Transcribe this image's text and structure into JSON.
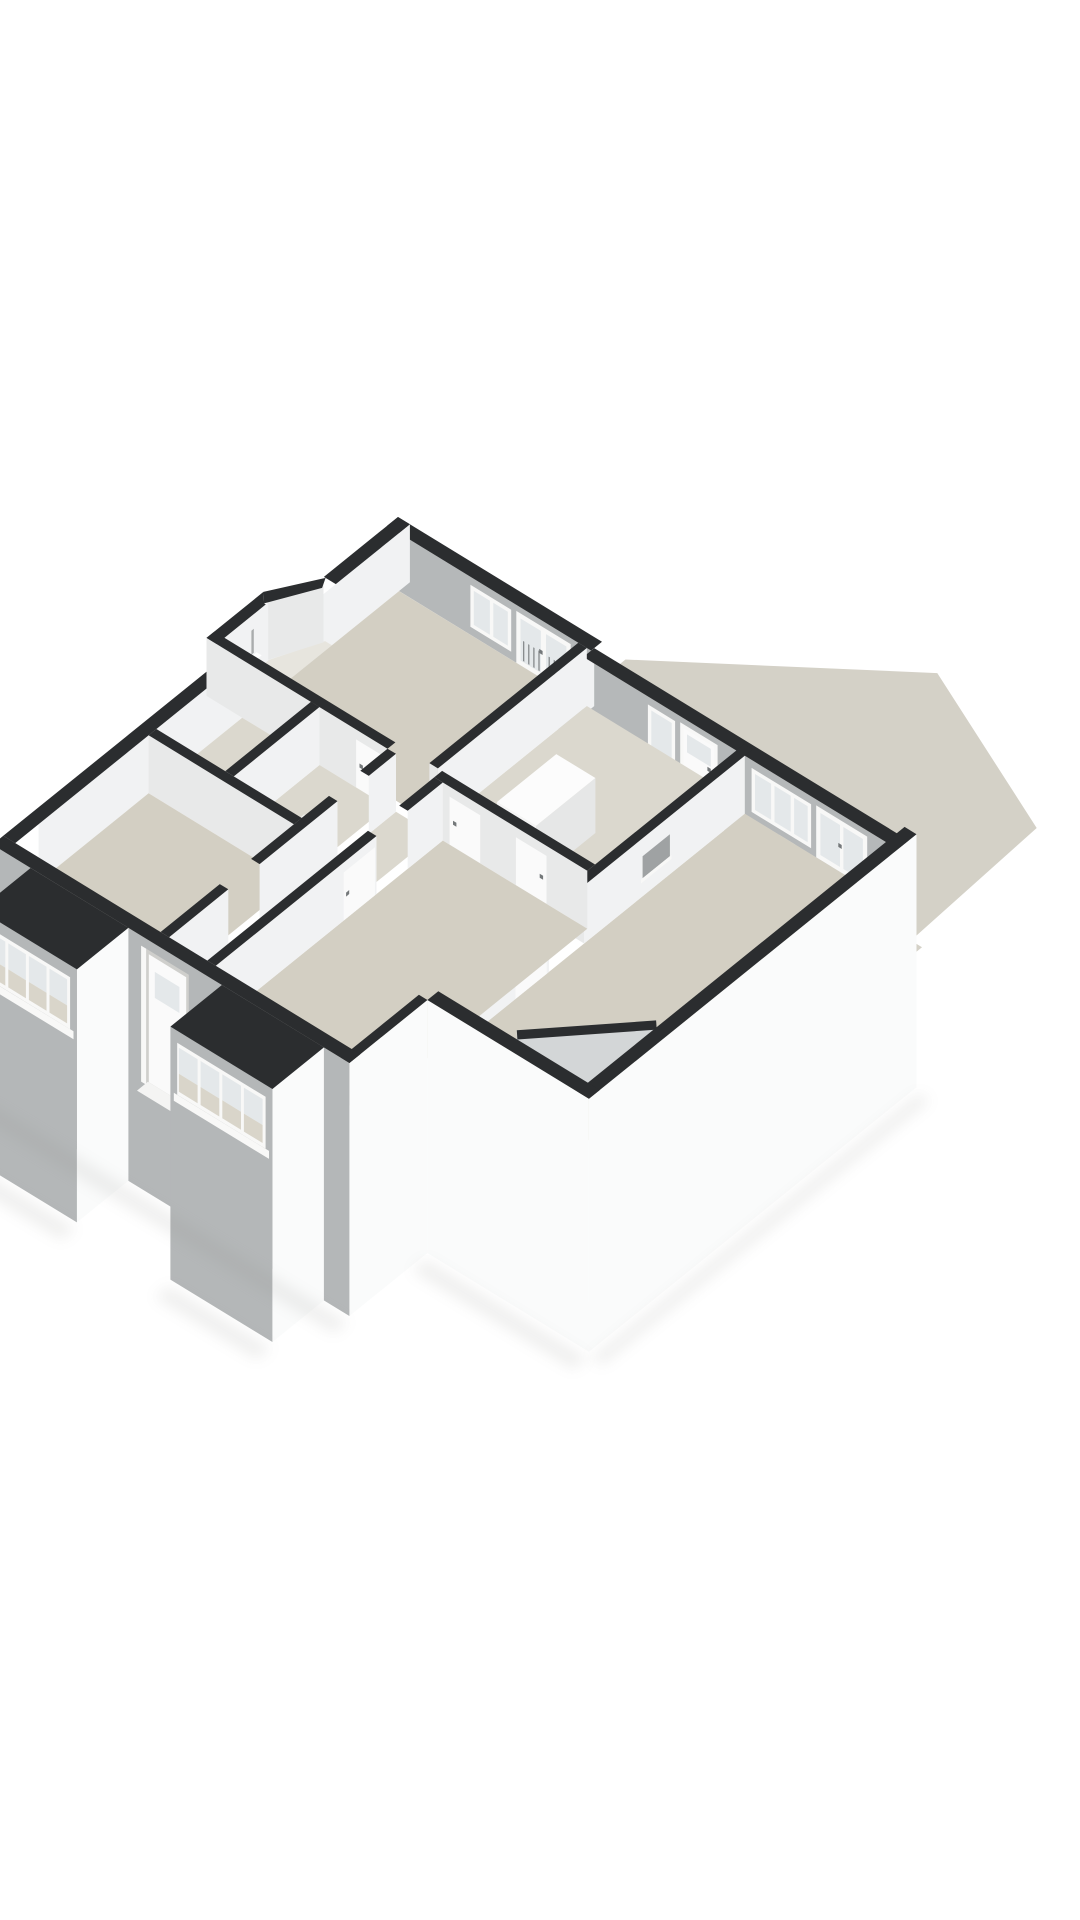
{
  "scene": {
    "type": "3d-floorplan-isometric-render",
    "background": "#ffffff",
    "colors": {
      "cap": "#2b2d2f",
      "neInner": "#b5b8b9",
      "interiorLight": "#f1f2f3",
      "interiorSoft": "#e8e9e9",
      "interiorMid": "#d3d6d7",
      "extWhite": "#fafbfb",
      "extGray": "#b4b7b8",
      "recess": "#cfcfcc",
      "frame": "#f8f8f7",
      "glass": "#e4e8ea",
      "glassLow": "#d9d5ca",
      "bars": "#7e8284",
      "doorLeaf": "#fafafa",
      "handle": "#74787a",
      "floor": "#d3cfc3",
      "floorLight": "#dbd8ce",
      "blockFloor": "#e7e5de",
      "garden": "#d4d1c7",
      "gardenStrip": "#c8c8c4",
      "stair": "#f4f4f3",
      "stairShade": "#e0dfda",
      "stairSide": "#eae9e5",
      "cabinetSide": "#e6e7e7",
      "cabinetFront": "#f5f5f5",
      "cabinetTop": "#fcfcfc",
      "fixture": "#ffffff",
      "fixtureTop": "#f0f0ed",
      "fixtureGray": "#a9acad",
      "nicheBack": "#9fa2a3",
      "shadow": "#8a8a86"
    },
    "elements": [
      "garden-terrace",
      "foundation-strip",
      "back-door-steps",
      "living-room-garden-steps",
      "top-bedroom",
      "top-bedroom-window",
      "top-bedroom-french-doors",
      "inner-hall",
      "hall-cabinet",
      "back-door",
      "hall-sidelight-window",
      "shower-nook",
      "bathroom",
      "toilet-room",
      "toilet",
      "hallway",
      "left-front-room",
      "middle-front-room",
      "living-room",
      "living-room-window",
      "living-room-french-doors",
      "living-room-niche",
      "under-stairs-closet",
      "front-door",
      "bay-window-left",
      "bay-window-middle"
    ]
  }
}
